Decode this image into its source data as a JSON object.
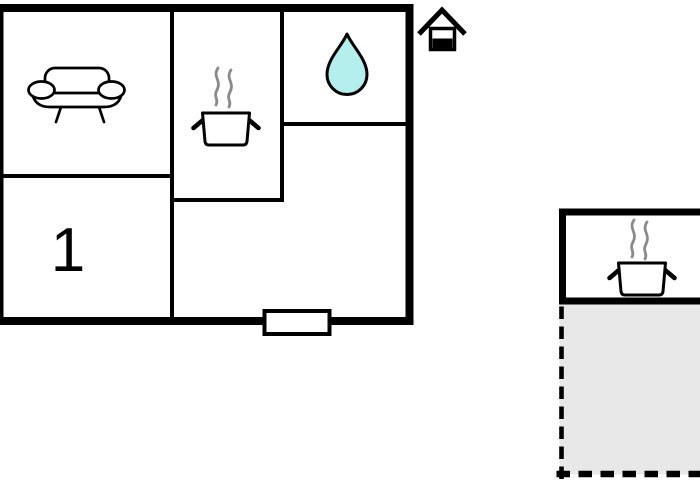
{
  "colors": {
    "wall": "#000000",
    "background": "#ffffff",
    "water_drop_fill": "#b4efed",
    "terrace_fill": "#e8e8e8",
    "steam_stroke": "#8a8a8a"
  },
  "main_building": {
    "bedroom": {
      "label": "1"
    },
    "icons": {
      "living_room": "sofa-icon",
      "kitchen": "cooking-pot-icon",
      "bathroom": "water-drop-icon",
      "entrance_marker": "house-icon",
      "entrance": "door-window-symbol"
    }
  },
  "annex": {
    "icons": {
      "kitchen": "cooking-pot-icon"
    },
    "terrace": {
      "outline": "dashed",
      "sides": [
        "left",
        "bottom"
      ]
    }
  }
}
